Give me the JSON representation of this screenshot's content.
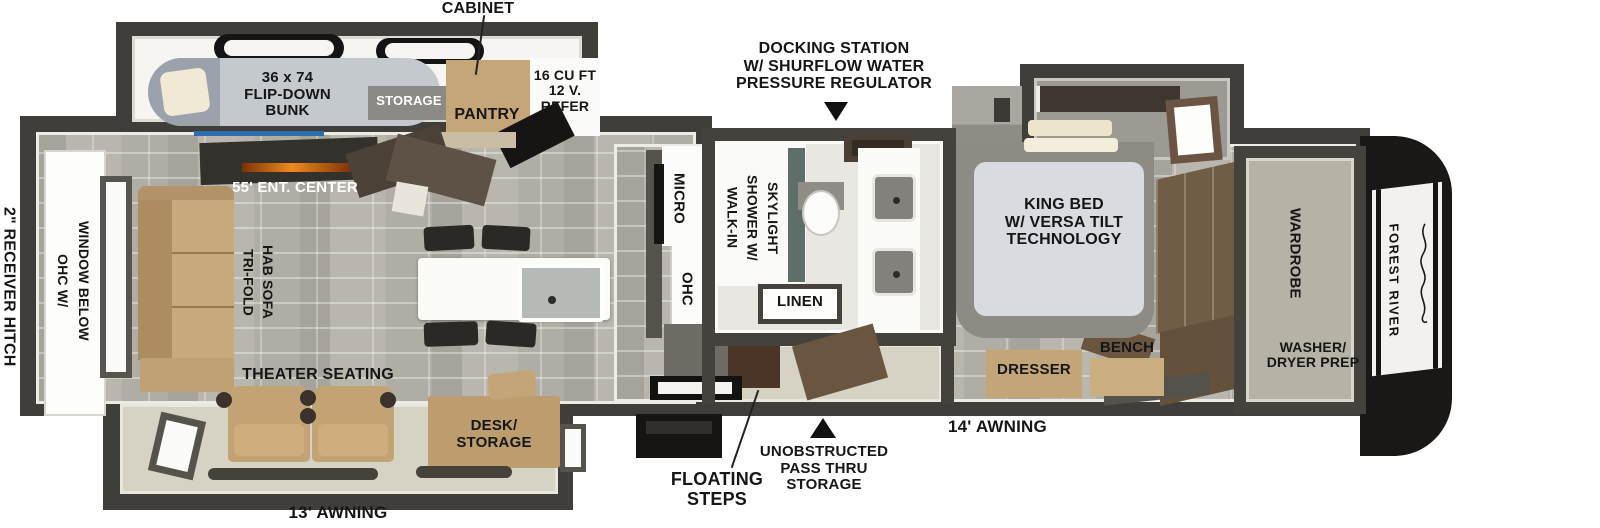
{
  "brand": {
    "name": "FOREST RIVER"
  },
  "callouts": {
    "cabinet": "CABINET",
    "docking_station": "DOCKING STATION\nW/ SHURFLOW WATER\nPRESSURE REGULATOR",
    "receiver_hitch": "2\" RECEIVER HITCH",
    "awning_rear": "13' AWNING",
    "awning_front": "14' AWNING",
    "floating_steps": "FLOATING\nSTEPS",
    "pass_thru": "UNOBSTRUCTED\nPASS THRU\nSTORAGE"
  },
  "bunk_room": {
    "bunk": "36 x 74\nFLIP-DOWN\nBUNK",
    "storage": "STORAGE",
    "pantry": "PANTRY",
    "refer": "16 CU FT\n12 V.\nREFER"
  },
  "living": {
    "ohc_window": "OHC W/\nWINDOW BELOW",
    "sofa": "TRI-FOLD\nHAB SOFA",
    "ent_center": "55' ENT. CENTER",
    "theater": "THEATER SEATING",
    "desk": "DESK/\nSTORAGE"
  },
  "kitchen": {
    "micro": "MICRO",
    "ohc": "OHC"
  },
  "bath": {
    "shower": "WALK-IN\nSHOWER W/\nSKYLIGHT",
    "linen": "LINEN"
  },
  "bedroom": {
    "king_bed": "KING BED\nW/ VERSA TILT\nTECHNOLOGY",
    "dresser": "DRESSER",
    "bench": "BENCH"
  },
  "front": {
    "wardrobe": "WARDROBE",
    "washer_dryer": "WASHER/\nDRYER PREP"
  },
  "colors": {
    "wall": "#403e3a",
    "floor_tile": "#b9b6ad",
    "floor_beige": "#d6d2c4",
    "wood_tan": "#c5a678",
    "wood_dark": "#6f5d45",
    "accent_blue": "#2e6cb0",
    "fireplace_orange": "#ef8a1e",
    "cap_black": "#191816"
  }
}
